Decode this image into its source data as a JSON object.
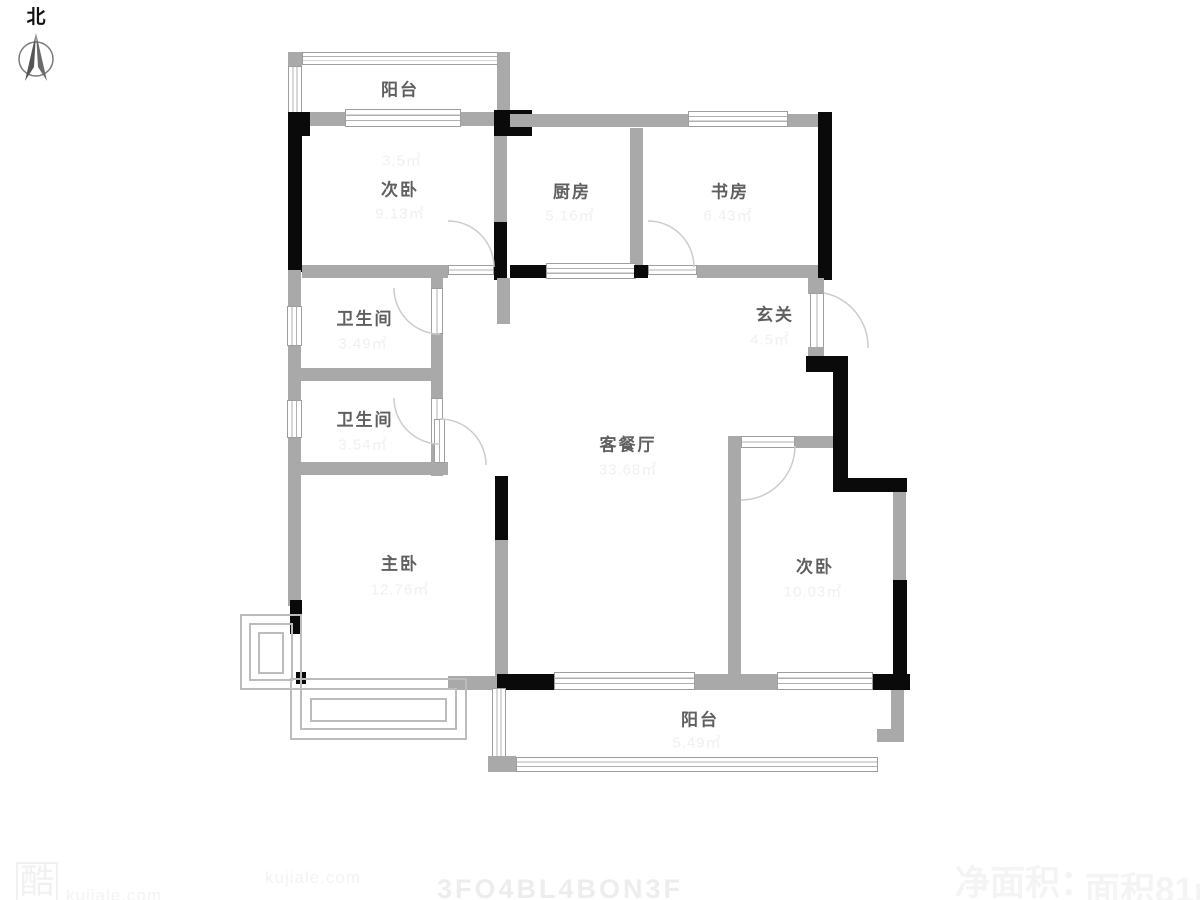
{
  "meta": {
    "wall_gray": "#a9a9a9",
    "wall_black": "#0a0a0a",
    "label_color": "#5f5f5f",
    "faint_color": "#f0f0f0",
    "background": "#ffffff"
  },
  "compass": {
    "label": "北"
  },
  "rooms": {
    "balcony_top": {
      "label": "阳台",
      "area": "3.5㎡"
    },
    "bedroom_top": {
      "label": "次卧",
      "area": "9.13㎡"
    },
    "kitchen": {
      "label": "厨房",
      "area": "5.16㎡"
    },
    "study": {
      "label": "书房",
      "area": "6.43㎡"
    },
    "bath1": {
      "label": "卫生间",
      "area": "3.49㎡"
    },
    "bath2": {
      "label": "卫生间",
      "area": "3.54㎡"
    },
    "entry": {
      "label": "玄关",
      "area": "4.5㎡"
    },
    "living": {
      "label": "客餐厅",
      "area": "33.68㎡"
    },
    "master": {
      "label": "主卧",
      "area": "12.76㎡"
    },
    "bedroom_br": {
      "label": "次卧",
      "area": "10.03㎡"
    },
    "balcony_bottom": {
      "label": "阳台",
      "area": "5.49㎡"
    }
  },
  "watermarks": {
    "logo": "酷",
    "site1": "kujiale.com",
    "site2": "kujiale.com",
    "code": "3FO4BL4BON3F",
    "note1": "净面积：",
    "note2": "面积81m²"
  }
}
